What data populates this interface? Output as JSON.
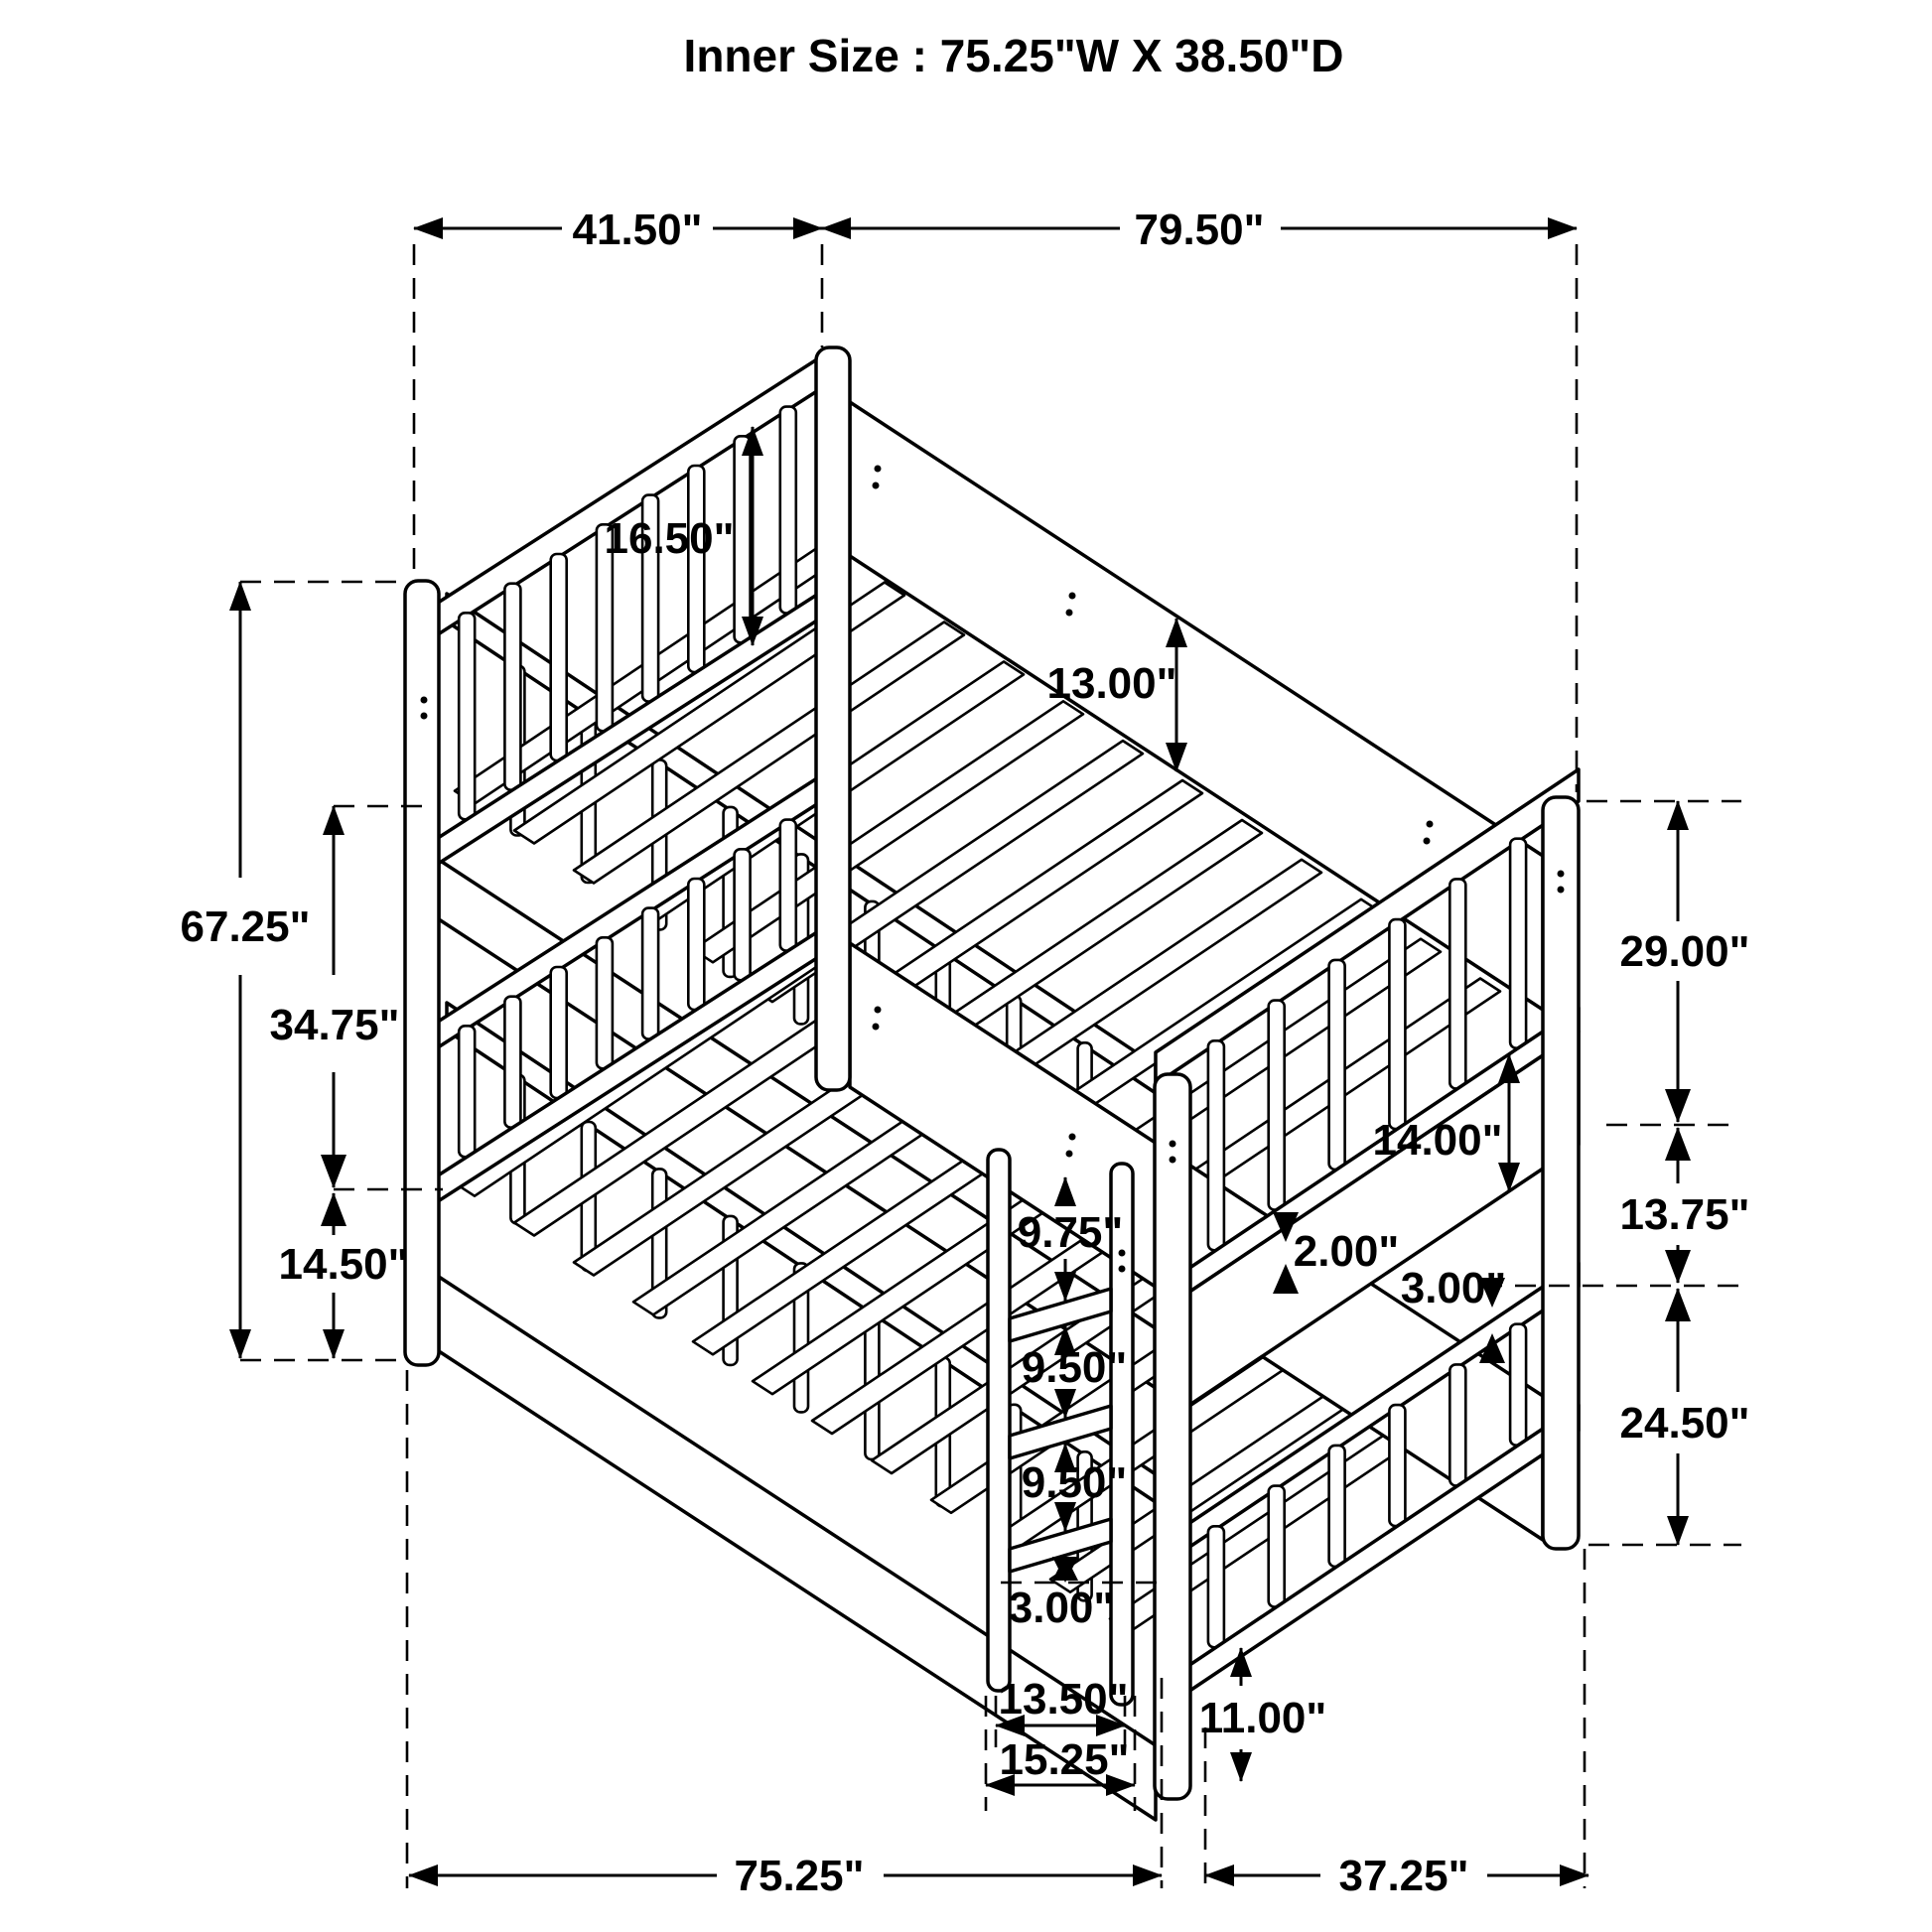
{
  "title": "Inner Size : 75.25\"W X  38.50\"D",
  "colors": {
    "line": "#000000",
    "background": "#ffffff"
  },
  "dimensions": {
    "top_depth": "41.50\"",
    "top_length": "79.50\"",
    "overall_height": "67.25\"",
    "headboard_panel_height": "16.50\"",
    "side_rail_height": "13.00\"",
    "upper_deck_height": "34.75\"",
    "lower_deck_height": "14.50\"",
    "right_upper_section": "29.00\"",
    "right_middle_section": "13.75\"",
    "right_lower_section": "24.50\"",
    "footboard_panel_height": "14.00\"",
    "slat_thickness": "2.00\"",
    "guard_gap": "3.00\"",
    "ladder_step_1": "9.75\"",
    "ladder_step_2": "9.50\"",
    "ladder_step_3": "9.50\"",
    "ladder_bottom_gap": "3.00\"",
    "ladder_inner_width": "13.50\"",
    "ladder_outer_width": "15.25\"",
    "ground_clearance": "11.00\"",
    "bottom_length": "75.25\"",
    "bottom_depth": "37.25\""
  }
}
